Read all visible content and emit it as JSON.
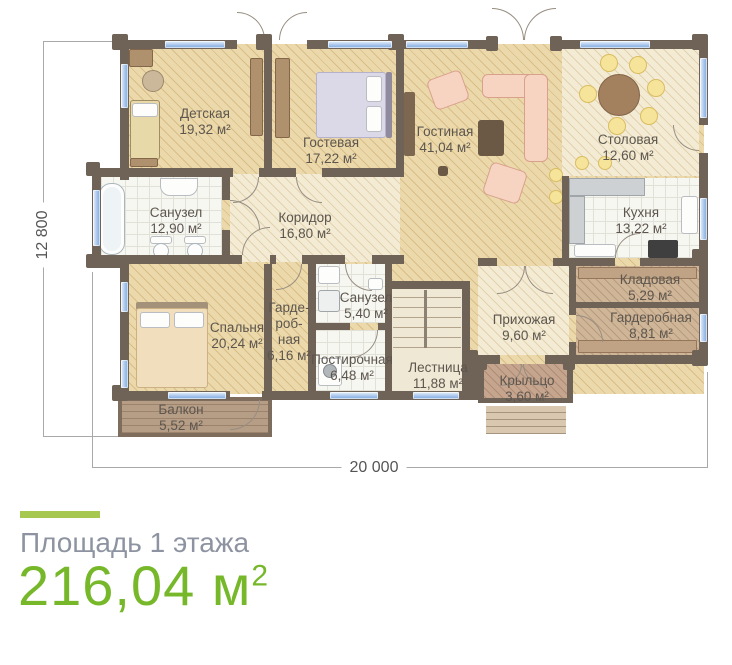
{
  "footer": {
    "label": "Площадь 1 этажа",
    "value": "216,04",
    "unit": " м",
    "sup": "2"
  },
  "dimensions": {
    "height": "12 800",
    "width": "20 000"
  },
  "rooms": [
    {
      "name": "Детская",
      "area": "19,32 м²"
    },
    {
      "name": "Гостевая",
      "area": "17,22 м²"
    },
    {
      "name": "Гостиная",
      "area": "41,04 м²"
    },
    {
      "name": "Столовая",
      "area": "12,60 м²"
    },
    {
      "name": "Санузел",
      "area": "12,90 м²"
    },
    {
      "name": "Коридор",
      "area": "16,80 м²"
    },
    {
      "name": "Кухня",
      "area": "13,22 м²"
    },
    {
      "name": "Кладовая",
      "area": "5,29 м²"
    },
    {
      "name": "Спальня",
      "area": "20,24 м²"
    },
    {
      "name": "Гарде-\nроб-\nная",
      "area": "6,16 м²"
    },
    {
      "name": "Санузел",
      "area": "5,40 м²"
    },
    {
      "name": "Постирочная",
      "area": "6,48 м²"
    },
    {
      "name": "Прихожая",
      "area": "9,60 м²"
    },
    {
      "name": "Гардеробная",
      "area": "8,81 м²"
    },
    {
      "name": "Лестница",
      "area": "11,88 м²"
    },
    {
      "name": "Балкон",
      "area": "5,52 м²"
    },
    {
      "name": "Крыльцо",
      "area": "3,60 м²"
    }
  ],
  "colors": {
    "accent_green": "#76b82a",
    "bar_green": "#a6c851",
    "footer_gray": "#8d93a0",
    "wall": "#6f6257",
    "window_blue": "#a9c6ec"
  }
}
